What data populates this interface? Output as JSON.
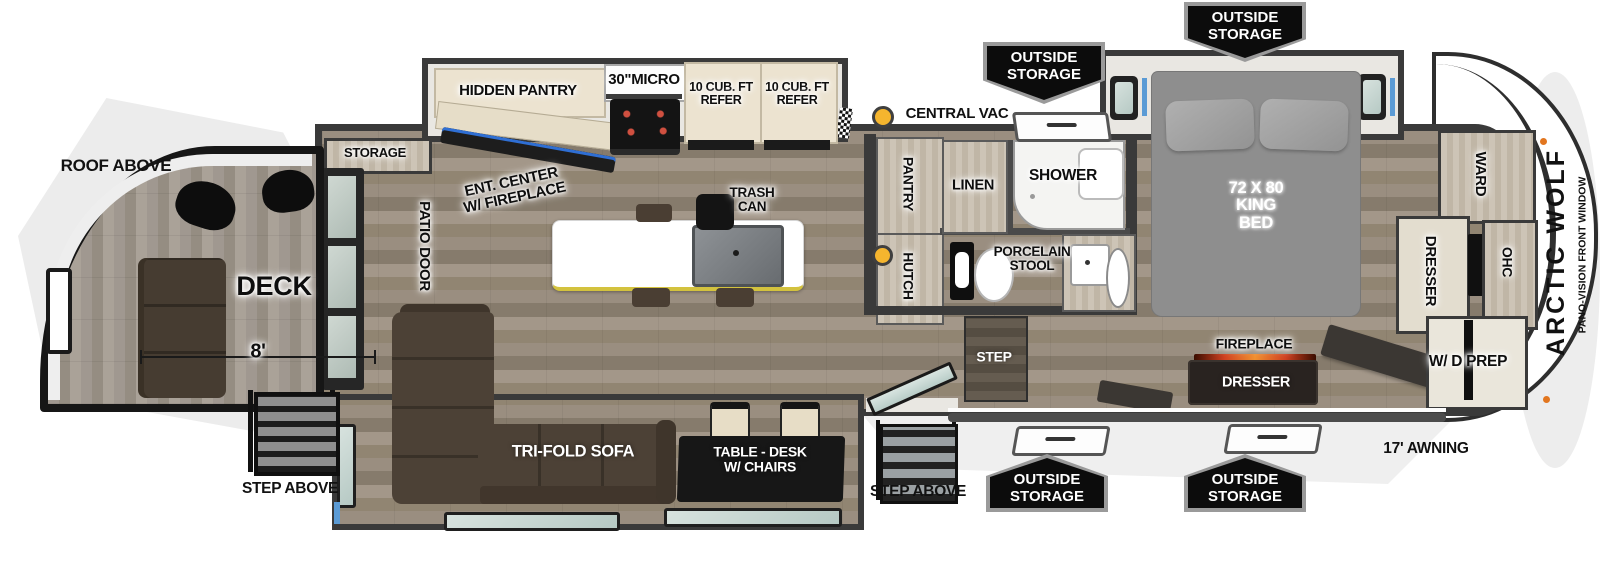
{
  "plan": {
    "brand": "ARCTIC WOLF",
    "front_window_note": "PANO-VISION FRONT WINDOW",
    "deck": {
      "roof": "ROOF ABOVE",
      "name": "DECK",
      "width": "8'",
      "steps": "STEP ABOVE"
    },
    "exterior": {
      "outside_storage_line1": "OUTSIDE",
      "outside_storage_line2": "STORAGE",
      "awning": "17' AWNING",
      "central_vac": "CENTRAL VAC",
      "entry_steps": "STEP ABOVE"
    },
    "kitchen": {
      "storage": "STORAGE",
      "patio_door": "PATIO DOOR",
      "hidden_pantry": "HIDDEN PANTRY",
      "micro": "30\"MICRO",
      "refer_line1": "10 CUB. FT",
      "refer_line2": "REFER",
      "ent_center_line1": "ENT. CENTER",
      "ent_center_line2": "W/ FIREPLACE",
      "trash_line1": "TRASH",
      "trash_line2": "CAN",
      "pantry": "PANTRY",
      "hutch": "HUTCH"
    },
    "living": {
      "sofa": "TRI-FOLD SOFA",
      "table_line1": "TABLE - DESK",
      "table_line2": "W/ CHAIRS",
      "step": "STEP"
    },
    "bath": {
      "linen": "LINEN",
      "shower": "SHOWER",
      "toilet_line1": "PORCELAIN",
      "toilet_line2": "STOOL"
    },
    "bedroom": {
      "bed_line1": "72 X 80",
      "bed_line2": "KING",
      "bed_line3": "BED",
      "ward": "WARD",
      "dresser": "DRESSER",
      "ohc": "OHC",
      "fireplace": "FIREPLACE",
      "dresser2": "DRESSER",
      "wd_prep": "W/ D PREP"
    }
  },
  "colors": {
    "wall": "#3a3a3a",
    "accent_blue": "#5b9bd5",
    "vac_dot_yellow": "#f5b52e",
    "badge_bg": "#0c0c0c",
    "cream_cabinet": "#ece3d0",
    "sofa_brown": "#4c4136",
    "bed_gray": "#8e8e8e",
    "island_white": "#ffffff",
    "island_edge_yellow": "#d3c23e",
    "fireplace_flame": "#f08030",
    "marker_orange": "#e2761f"
  }
}
